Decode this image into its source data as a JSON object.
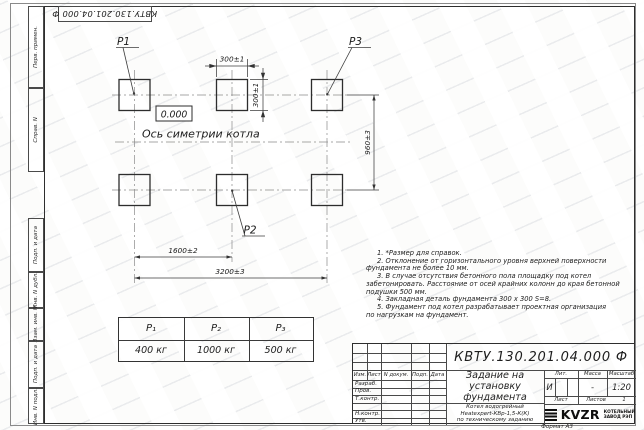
{
  "page": {
    "format_label": "Формат А3"
  },
  "corner_stamp": {
    "doc_number": "КВТУ.130.201.04.000 Ф"
  },
  "margin_column": {
    "cells": [
      "Перв. примен.",
      "Справ. N",
      "Подп. и дата",
      "Инв. N дубл.",
      "Взам. инв. N",
      "Подп. и дата",
      "Инв. N подл."
    ]
  },
  "drawing": {
    "point_labels": {
      "p1": "P1",
      "p2": "P2",
      "p3": "P3"
    },
    "elevation": "0.000",
    "axis_label": "Ось симетрии котла",
    "dims": {
      "top_width": "300±1",
      "side_height": "300±1",
      "row_spacing": "960±3",
      "half_span": "1600±2",
      "full_span": "3200±3"
    }
  },
  "notes": {
    "lines": [
      "1. *Размер для справок.",
      "2. Отклонение от горизонтального уровня верхней поверхности",
      "фундамента не более 10 мм.",
      "3. В случае отсутствия бетонного пола площадку под котел",
      "забетонировать. Расстояние от осей крайних колонн до края бетонной",
      "подушки 500 мм.",
      "4. Закладная деталь фундамента 300 x 300 S=8.",
      "5. Фундамент под котел разрабатывает проектная организация",
      "по нагрузкам на фундамент."
    ]
  },
  "load_table": {
    "headers": [
      "P₁",
      "P₂",
      "P₃"
    ],
    "values": [
      "400 кг",
      "1000 кг",
      "500 кг"
    ]
  },
  "title_block": {
    "doc_number": "КВТУ.130.201.04.000 Ф",
    "title_lines": [
      "Задание на",
      "установку",
      "фундамента"
    ],
    "org_lines": [
      "Котел водогрейный",
      "Heatexpert-КВр-1,5-К(К)",
      "по техническому заданию"
    ],
    "header_cols": [
      "Изм.",
      "Лист",
      "N докум.",
      "Подп.",
      "Дата"
    ],
    "staff_rows": [
      "Разраб.",
      "Пров.",
      "Т.контр.",
      "",
      "Н.контр.",
      "Утв."
    ],
    "lit_label": "Лит.",
    "lit_value": "И",
    "mass_label": "Масса",
    "mass_value": "-",
    "scale_label": "Масштаб",
    "scale_value": "1:20",
    "sheet_label": "Лист",
    "sheets_label": "Листов",
    "sheets_value": "1",
    "logo": {
      "brand": "KVZR",
      "sub1": "КОТЕЛЬНЫЙ",
      "sub2": "ЗАВОД РЭП"
    }
  }
}
